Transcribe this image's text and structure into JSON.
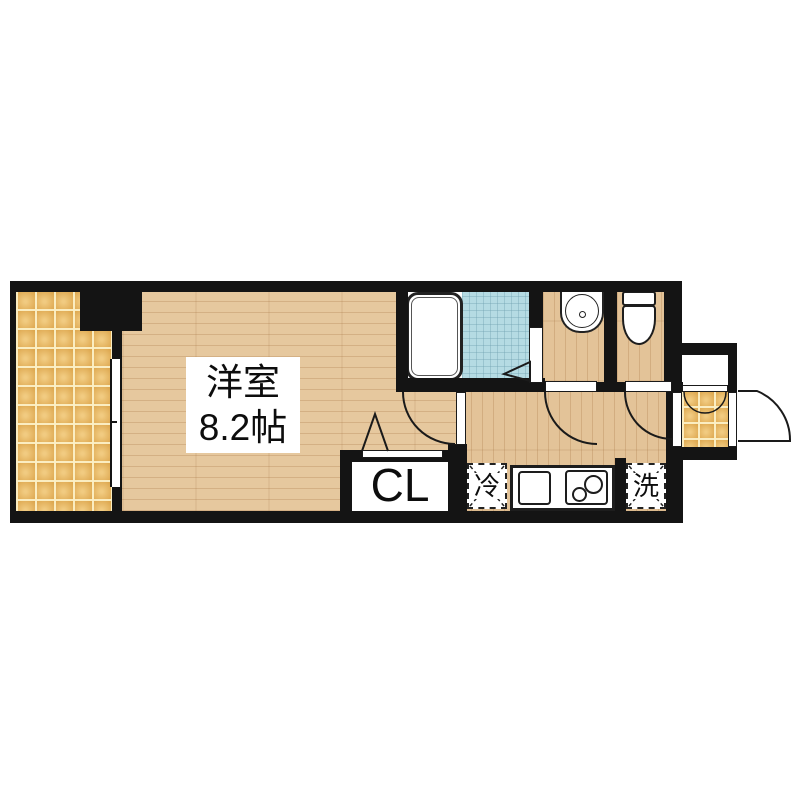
{
  "rooms": {
    "main_room": {
      "label_line1": "洋室",
      "label_line2": "8.2帖"
    },
    "closet": {
      "label": "CL"
    },
    "kitchen": {
      "fridge": "冷",
      "washer": "洗"
    }
  },
  "colors": {
    "wall": "#141414",
    "wood_floor": "#e6c89e",
    "balcony_tile": "#e9bd6d",
    "bath_tile": "#b5dbe3",
    "fixture_white": "#ffffff",
    "text": "#0d0d0d"
  }
}
